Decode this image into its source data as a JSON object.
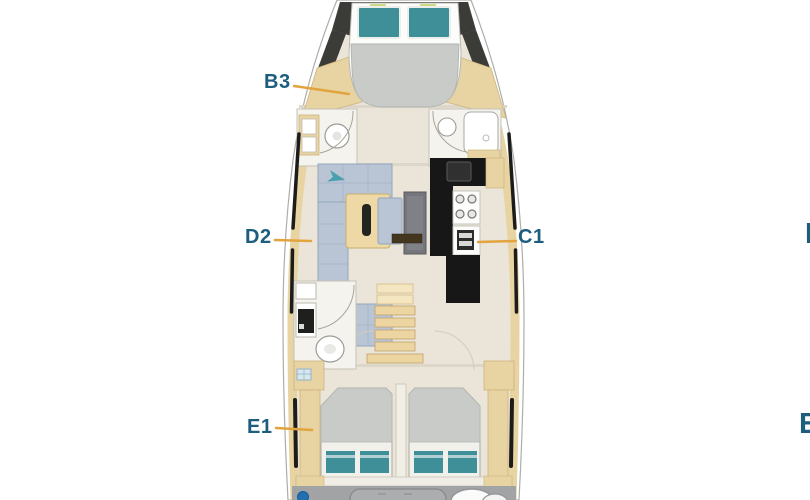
{
  "canvas": {
    "width": 810,
    "height": 500,
    "background": "#ffffff"
  },
  "floorplan": {
    "type": "sailing-yacht-deck-plan",
    "labels": {
      "b3": "B3",
      "d2": "D2",
      "c1": "C1",
      "e1": "E1",
      "right_top_partial": "D",
      "right_bottom_partial": "E"
    },
    "colors": {
      "label_text": "#1d5d7e",
      "leader_line": "#e2a43e",
      "hull_white": "#ffffff",
      "deck_floor": "#eae5d8",
      "wood_trim": "#e8d3a2",
      "sofa_upholstery": "#b9c5d5",
      "mattress_gray": "#c8cbc8",
      "pillow_teal": "#3f8f98",
      "galley_counter": "#171717",
      "dark_bow_panel": "#3b3b37",
      "cockpit_gray": "#a2a3a5",
      "accent_dot_blue": "#2270b2"
    }
  }
}
